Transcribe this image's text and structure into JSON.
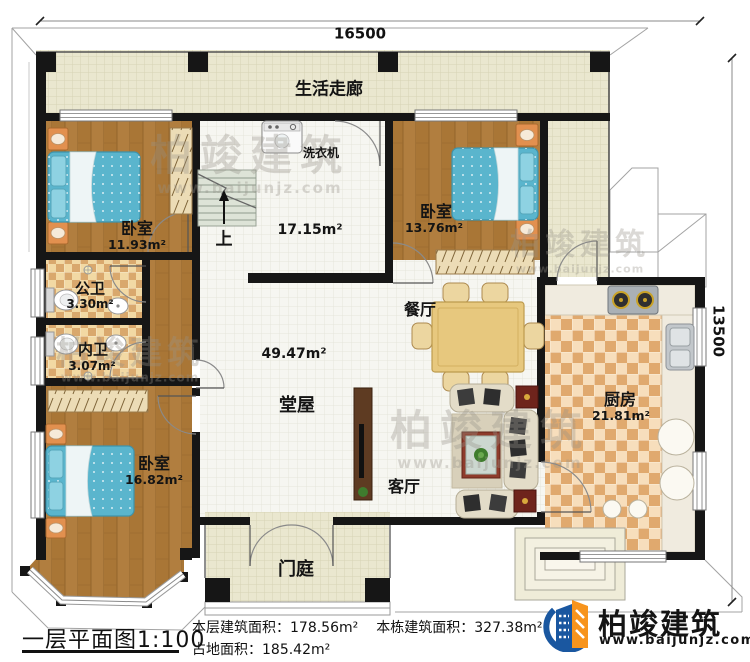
{
  "dimensions": {
    "top": "16500",
    "right": "13500"
  },
  "rooms": {
    "corridor": {
      "name": "生活走廊"
    },
    "utility": {
      "area": "17.15m²",
      "washer": "洗衣机",
      "up": "上"
    },
    "bedroom1": {
      "name": "卧室",
      "area": "11.93m²"
    },
    "bedroom2": {
      "name": "卧室",
      "area": "13.76m²"
    },
    "bedroom3": {
      "name": "卧室",
      "area": "16.82m²"
    },
    "bath_public": {
      "name": "公卫",
      "area": "3.30m²"
    },
    "bath_private": {
      "name": "内卫",
      "area": "3.07m²"
    },
    "hall": {
      "name": "堂屋",
      "area": "49.47m²"
    },
    "dining": {
      "name": "餐厅"
    },
    "living": {
      "name": "客厅"
    },
    "kitchen": {
      "name": "厨房",
      "area": "21.81m²"
    },
    "porch": {
      "name": "门庭"
    }
  },
  "footer": {
    "title": "一层平面图1:100",
    "stats": [
      {
        "label": "本层建筑面积：",
        "value": "178.56m²"
      },
      {
        "label": "本栋建筑面积：",
        "value": "327.38m²"
      },
      {
        "label": "占地面积：",
        "value": "185.42m²"
      }
    ],
    "logo": {
      "name": "柏竣建筑",
      "website": "www.baijunjz.com"
    }
  },
  "watermark": {
    "text": "柏竣建筑",
    "website": "www.baijunjz.com"
  },
  "colors": {
    "wall": "#161616",
    "wood": "#b17e3f",
    "tile_beige": "#eae7cf",
    "tile_white": "#f6f6f1",
    "bath_check": "#d9a86d",
    "kitchen_check": "#e0a96e",
    "bed_blue": "#5ab5cd",
    "logo_blue": "#1a57a0",
    "logo_orange": "#f7941d"
  }
}
